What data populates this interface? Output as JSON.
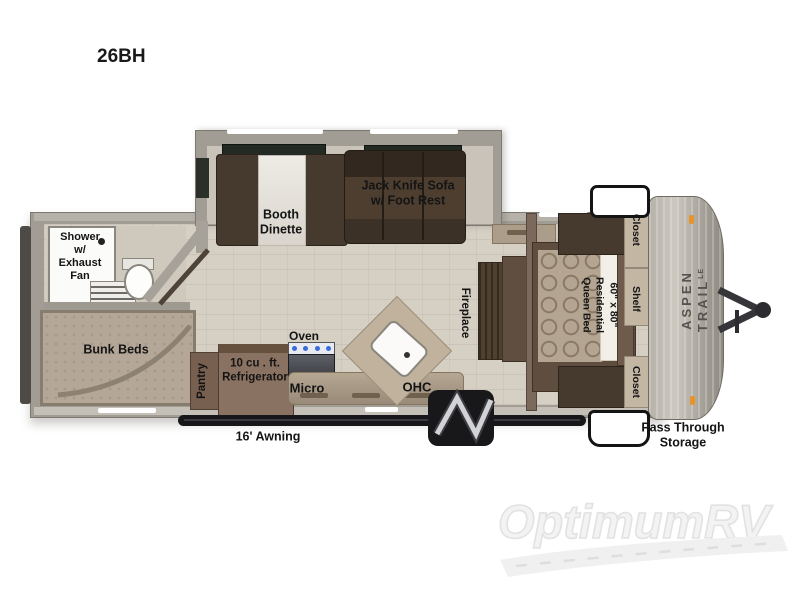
{
  "page": {
    "title": "26BH"
  },
  "slideout": {
    "booth_dinette": "Booth\nDinette",
    "jack_knife_sofa": "Jack Knife Sofa\nw/ Foot Rest"
  },
  "bathroom": {
    "shower": "Shower\nw/\nExhaust\nFan"
  },
  "bunk_room": {
    "bunk_beds": "Bunk Beds"
  },
  "kitchen": {
    "oven": "Oven",
    "pantry": "Pantry",
    "refrigerator": "10 cu . ft.\nRefrigerator",
    "micro": "Micro",
    "ohc": "OHC"
  },
  "living": {
    "fireplace": "Fireplace"
  },
  "bedroom": {
    "queen_bed": "60\" x 80\"\nResidential\nQueen Bed",
    "closet_top": "Closet",
    "shelf": "Shelf",
    "closet_bottom": "Closet"
  },
  "exterior": {
    "awning": "16' Awning",
    "pass_through": "Pass Through\nStorage",
    "brand": "ASPEN TRAIL",
    "brand_suffix": "LE"
  },
  "watermark": {
    "logo": "OptimumRV"
  },
  "colors": {
    "wall_gray": "#a19d95",
    "floor_tan": "#d6cfc4",
    "dark_wood": "#46392e",
    "mid_wood": "#77604f",
    "counter_tan": "#ab9d89",
    "marker_orange": "#e8922a",
    "watermark_gray": "#ededed"
  }
}
